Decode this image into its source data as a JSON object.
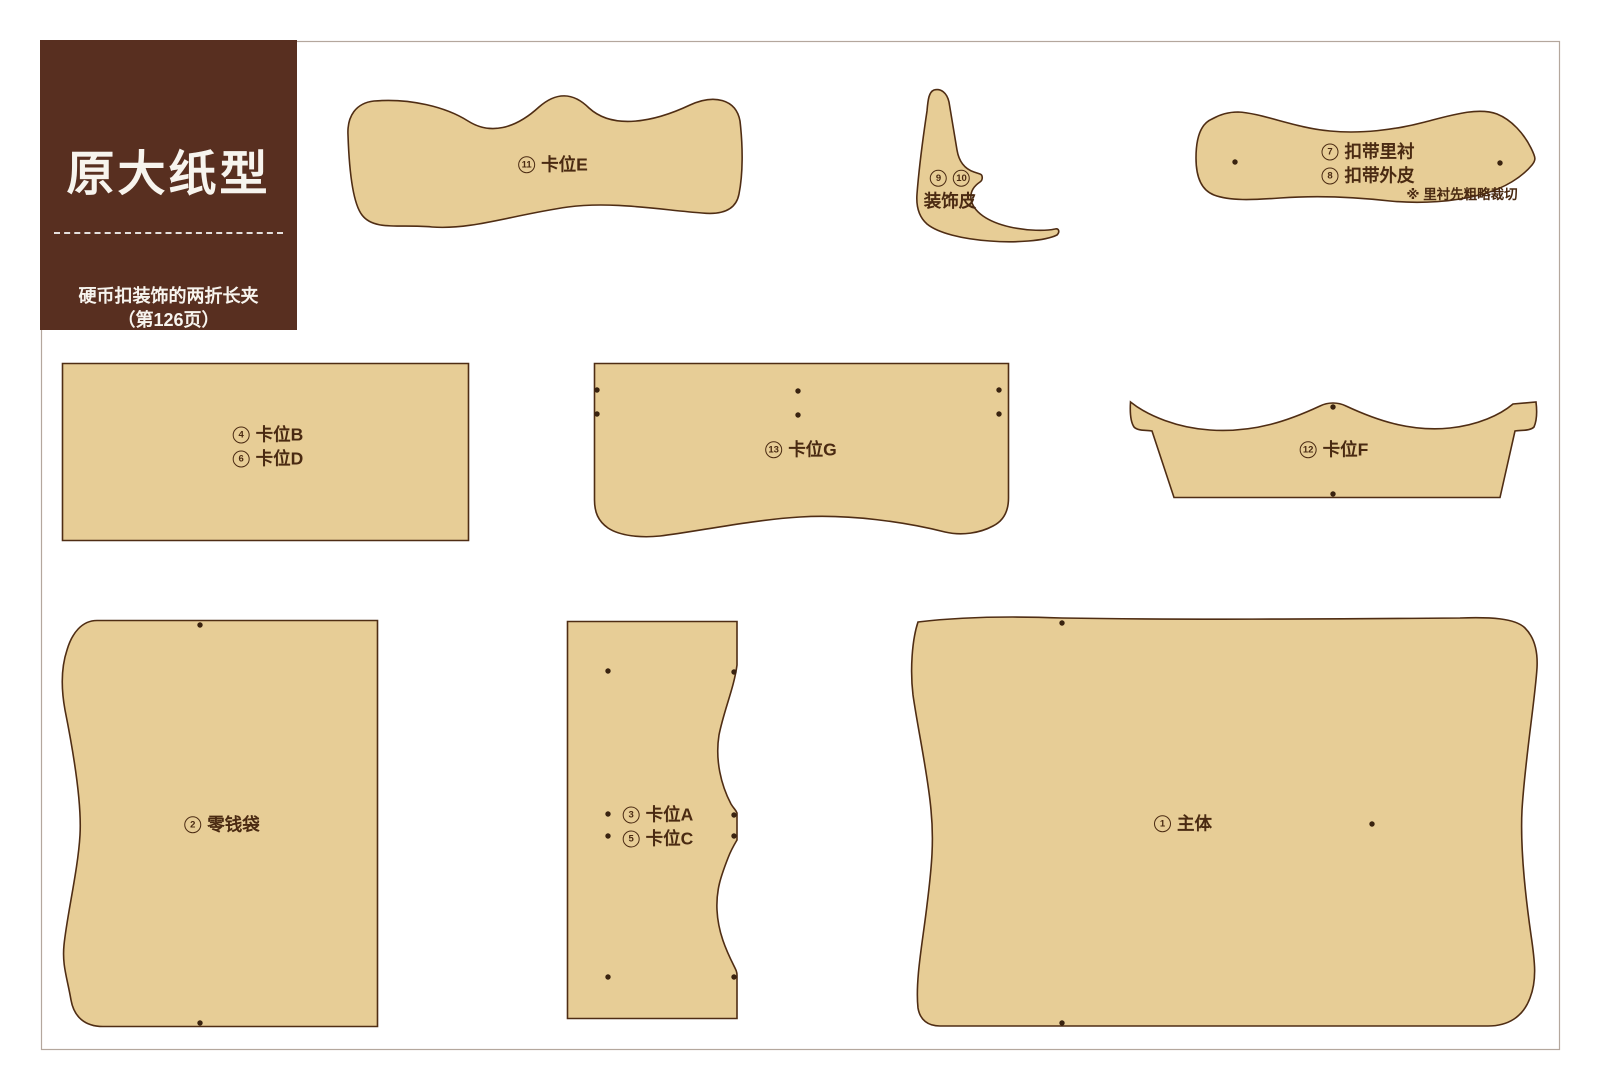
{
  "header": {
    "title": "原大纸型",
    "project": "硬币扣装饰的两折长夹",
    "page_ref": "（第126页）"
  },
  "pieces": {
    "main_body": {
      "num": "1",
      "name": "主体"
    },
    "coin_pocket": {
      "num": "2",
      "name": "零钱袋"
    },
    "card_slots_ac": {
      "rows": [
        {
          "num": "3",
          "name": "卡位A"
        },
        {
          "num": "5",
          "name": "卡位C"
        }
      ]
    },
    "card_slots_bd": {
      "rows": [
        {
          "num": "4",
          "name": "卡位B"
        },
        {
          "num": "6",
          "name": "卡位D"
        }
      ]
    },
    "strap": {
      "rows": [
        {
          "num": "7",
          "name": "扣带里衬"
        },
        {
          "num": "8",
          "name": "扣带外皮"
        }
      ],
      "note": "※ 里衬先粗略裁切"
    },
    "decor_leather": {
      "nums": [
        "9",
        "10"
      ],
      "name": "装饰皮"
    },
    "card_slot_e": {
      "num": "11",
      "name": "卡位E"
    },
    "card_slot_f": {
      "num": "12",
      "name": "卡位F"
    },
    "card_slot_g": {
      "num": "13",
      "name": "卡位G"
    }
  },
  "colors": {
    "page_bg": "#ffffff",
    "frame": "#b4a79d",
    "piece_fill": "#e7cd96",
    "piece_outline": "#4f2d14",
    "label_ink": "#4a2a12",
    "dot": "#3a2310",
    "header_bg": "#582f20",
    "header_text": "#f7f4ee"
  }
}
